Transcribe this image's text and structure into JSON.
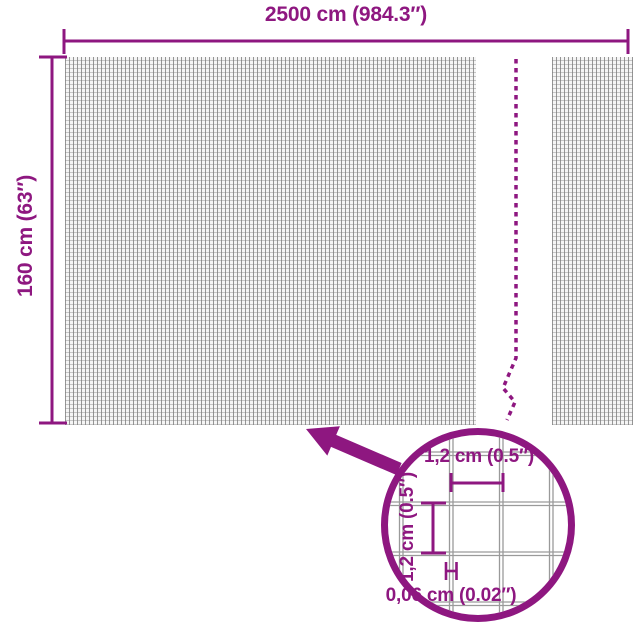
{
  "diagram": {
    "type": "product-dimension-diagram",
    "subject": "mesh-fabric-roll",
    "top_dimension": {
      "label": "2500 cm (984.3″)"
    },
    "left_dimension": {
      "label": "160 cm (63″)"
    },
    "detail_circle": {
      "cell_width_label": "1,2 cm (0.5″)",
      "cell_height_label": "1,2 cm (0.5″)",
      "wire_thickness_label": "0,06 cm (0.02″)"
    },
    "icons": {
      "magnifier_arrow": "arrow-up-left",
      "break_line": "dashed-vertical-break",
      "dimension_caps": "t-bar-ends"
    },
    "colors": {
      "accent": "#8E1780",
      "mesh_line_dark": "#7D7D7D",
      "mesh_line_light": "#969696",
      "mesh_background": "#F5F5F5",
      "detail_grid_line": "#9A9A9A",
      "page_background": "#FFFFFF"
    }
  }
}
